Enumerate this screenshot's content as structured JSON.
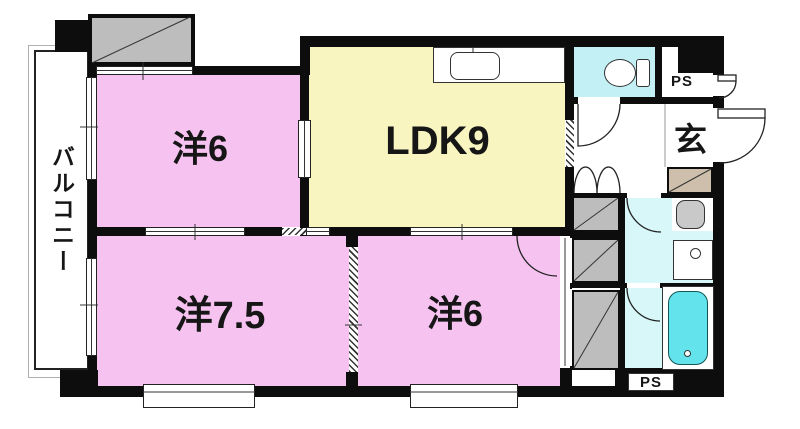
{
  "floorplan": {
    "balcony": {
      "label": "バルコニー"
    },
    "rooms": {
      "bedroom_top": {
        "label": "洋6"
      },
      "ldk": {
        "label": "LDK9"
      },
      "bedroom_left": {
        "label": "洋7.5"
      },
      "bedroom_right": {
        "label": "洋6"
      },
      "entrance": {
        "label": "玄"
      },
      "pipe_shaft_top": {
        "label": "PS"
      },
      "pipe_shaft_bottom": {
        "label": "PS"
      }
    },
    "colors": {
      "wall": "#0d0d0d",
      "pink": "#f6c3f0",
      "yellow": "#f8f5c0",
      "cyan": "#c3f0f4",
      "cyanLight": "#d7f7f9",
      "tub": "#63e4ec",
      "gray": "#bdbdbd",
      "tan": "#cdbfab"
    }
  }
}
